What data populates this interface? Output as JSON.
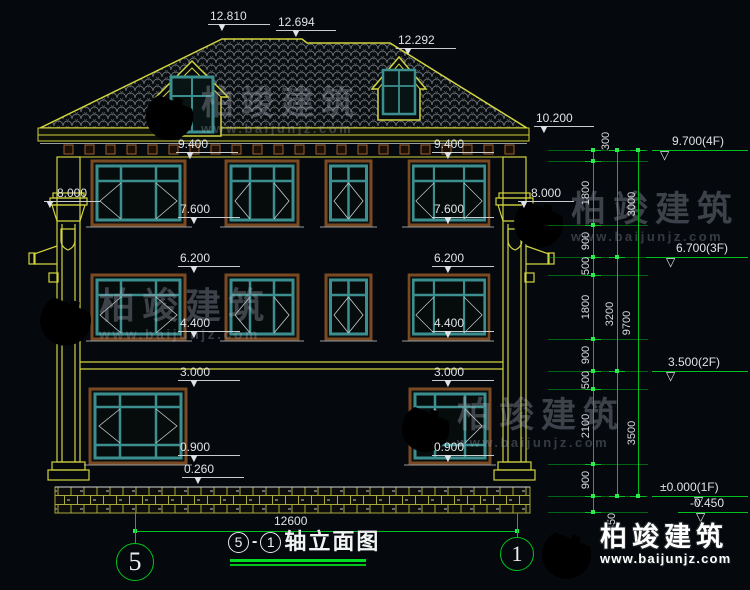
{
  "axes": {
    "left": "5",
    "right": "1"
  },
  "title": {
    "ref_from": "5",
    "sep": "-",
    "ref_to": "1",
    "name": "轴立面图"
  },
  "watermark": {
    "brand": "柏竣建筑",
    "site": "www.baijunjz.com"
  },
  "brand": {
    "name": "柏竣建筑",
    "site": "www.baijunjz.com"
  },
  "colors": {
    "dim_green": "#00bf1e",
    "cad_yellow": "#d2d43f",
    "frame_teal": "#3c8f8f",
    "frame_brown": "#7a4a22",
    "text_white": "#e0e3e5",
    "logo_blue": "#1464be",
    "logo_orange": "#f5a41c",
    "underline_green": "#00dd22"
  },
  "drawing": {
    "elev_marks": [
      {
        "t": "12.810",
        "x": 208,
        "y": 9,
        "w": 62,
        "tx": 8
      },
      {
        "t": "12.694",
        "x": 276,
        "y": 15,
        "w": 60,
        "tx": 14
      },
      {
        "t": "12.292",
        "x": 396,
        "y": 33,
        "w": 60,
        "tx": 6
      },
      {
        "t": "10.200",
        "x": 534,
        "y": 111,
        "w": 60,
        "tx": 4
      },
      {
        "t": "9.400",
        "x": 176,
        "y": 137,
        "w": 62,
        "tx": 8
      },
      {
        "t": "9.400",
        "x": 432,
        "y": 137,
        "w": 62,
        "tx": 10
      },
      {
        "t": "8.000",
        "x": 44,
        "y": 186,
        "w": 56,
        "tx": 0,
        "ta": "c"
      },
      {
        "t": "8.000",
        "x": 518,
        "y": 186,
        "w": 56,
        "tx": 0,
        "ta": "c"
      },
      {
        "t": "7.600",
        "x": 178,
        "y": 202,
        "w": 62,
        "tx": 10
      },
      {
        "t": "7.600",
        "x": 432,
        "y": 202,
        "w": 62,
        "tx": 10
      },
      {
        "t": "6.200",
        "x": 178,
        "y": 251,
        "w": 62,
        "tx": 10
      },
      {
        "t": "6.200",
        "x": 432,
        "y": 251,
        "w": 62,
        "tx": 10
      },
      {
        "t": "4.400",
        "x": 178,
        "y": 316,
        "w": 62,
        "tx": 10
      },
      {
        "t": "4.400",
        "x": 432,
        "y": 316,
        "w": 62,
        "tx": 10
      },
      {
        "t": "3.000",
        "x": 178,
        "y": 365,
        "w": 62,
        "tx": 10
      },
      {
        "t": "3.000",
        "x": 432,
        "y": 365,
        "w": 62,
        "tx": 10
      },
      {
        "t": "0.900",
        "x": 178,
        "y": 440,
        "w": 62,
        "tx": 10
      },
      {
        "t": "0.900",
        "x": 432,
        "y": 440,
        "w": 62,
        "tx": 10
      },
      {
        "t": "0.260",
        "x": 182,
        "y": 462,
        "w": 62,
        "tx": 10
      },
      {
        "t": "12600",
        "x": 272,
        "y": 514,
        "w": 0
      }
    ],
    "levels": [
      {
        "t": "9.700(4F)",
        "y": 150,
        "x1": 652,
        "x2": 748,
        "tx": 660,
        "txt_x": 672
      },
      {
        "t": "6.700(3F)",
        "y": 257,
        "x1": 646,
        "x2": 748,
        "tx": 666,
        "txt_x": 676
      },
      {
        "t": "3.500(2F)",
        "y": 371,
        "x1": 652,
        "x2": 748,
        "tx": 666,
        "txt_x": 668
      },
      {
        "t": "±0.000(1F)",
        "y": 496,
        "x1": 652,
        "x2": 748,
        "tx": 694,
        "txt_x": 660
      },
      {
        "t": "-0.450",
        "y": 512,
        "x1": 678,
        "x2": 748,
        "tx": 696,
        "txt_x": 690
      }
    ],
    "chains": [
      {
        "x": 593,
        "ticks": [
          150,
          161,
          225,
          257,
          275,
          339,
          371,
          389,
          464,
          496,
          512
        ],
        "labels": [
          {
            "t": "300",
            "x": 606,
            "y": 141
          },
          {
            "t": "1800",
            "x": 586,
            "y": 193
          },
          {
            "t": "900",
            "x": 586,
            "y": 241
          },
          {
            "t": "500",
            "x": 586,
            "y": 266
          },
          {
            "t": "1800",
            "x": 586,
            "y": 307
          },
          {
            "t": "900",
            "x": 586,
            "y": 355
          },
          {
            "t": "500",
            "x": 586,
            "y": 380
          },
          {
            "t": "2100",
            "x": 586,
            "y": 426
          },
          {
            "t": "900",
            "x": 586,
            "y": 480
          },
          {
            "t": "450",
            "x": 612,
            "y": 522
          }
        ]
      },
      {
        "x": 617,
        "ticks": [
          150,
          257,
          371,
          496
        ],
        "labels": [
          {
            "t": "3000",
            "x": 632,
            "y": 204
          },
          {
            "t": "3200",
            "x": 610,
            "y": 314
          },
          {
            "t": "3500",
            "x": 632,
            "y": 433
          }
        ]
      },
      {
        "x": 638,
        "ticks": [
          150,
          496
        ],
        "labels": [
          {
            "t": "9700",
            "x": 627,
            "y": 323
          }
        ]
      }
    ],
    "ext_lines": [
      150,
      161,
      225,
      257,
      275,
      339,
      371,
      389,
      464,
      496,
      512
    ],
    "ground": {
      "y": 531,
      "x1": 135,
      "x2": 517,
      "verts": [
        {
          "x": 135,
          "y1": 513,
          "y2": 543
        },
        {
          "x": 517,
          "y1": 513,
          "y2": 537
        }
      ]
    }
  }
}
